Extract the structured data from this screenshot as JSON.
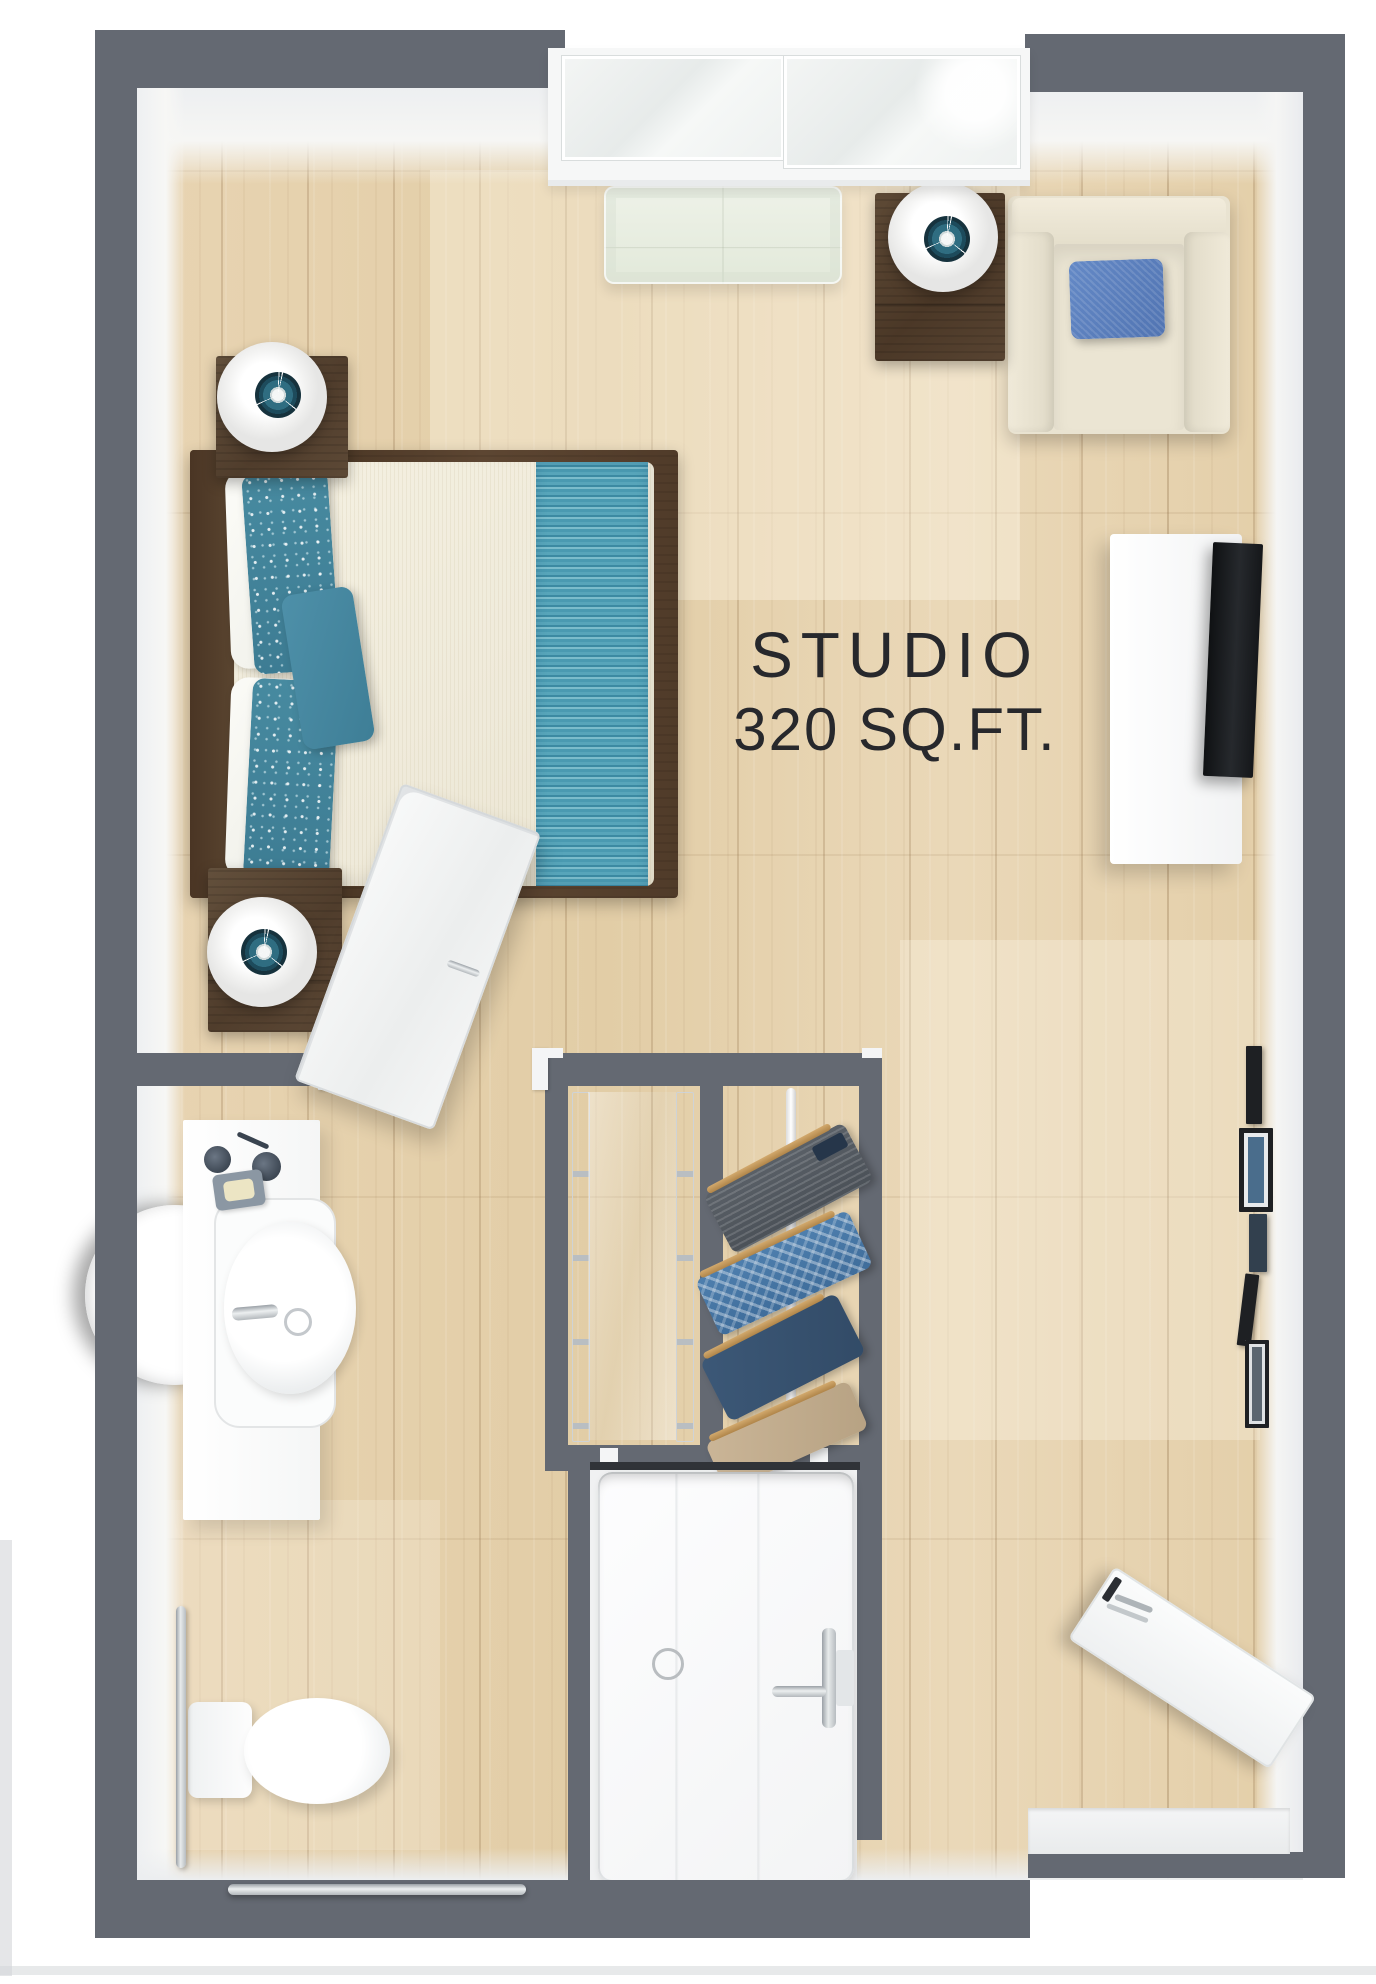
{
  "label": {
    "line1": "STUDIO",
    "line2": "320 SQ.FT."
  },
  "colors": {
    "wall": "#646972",
    "inner_wall": "#f1f2f4",
    "floor": "#e6d2ae",
    "wood_furniture": "#5a452f",
    "accent_teal": "#4a95ac",
    "accent_blue": "#5b80bd",
    "cream": "#eae4d2",
    "fixture_white": "#fbfbfc"
  },
  "furniture": [
    "queen-bed",
    "headboard",
    "striped-runner",
    "white-pillow",
    "floral-pillow",
    "teal-accent-pillow",
    "nightstand",
    "table-lamp",
    "armchair",
    "blue-throw-pillow",
    "media-console",
    "tv",
    "window",
    "ac-unit",
    "wall-picture-frames",
    "bathroom-vanity",
    "sink",
    "faucet",
    "soap-dish",
    "tumblers",
    "round-mirror",
    "toilet",
    "grab-bar-vertical",
    "grab-bar-horizontal",
    "closet-rod",
    "gray-jacket",
    "plaid-shirt",
    "navy-shirt",
    "tan-shirt",
    "glass-closet-doors",
    "entry-door",
    "door-lever",
    "peephole",
    "bathroom-door",
    "side-entry-door",
    "threshold"
  ]
}
